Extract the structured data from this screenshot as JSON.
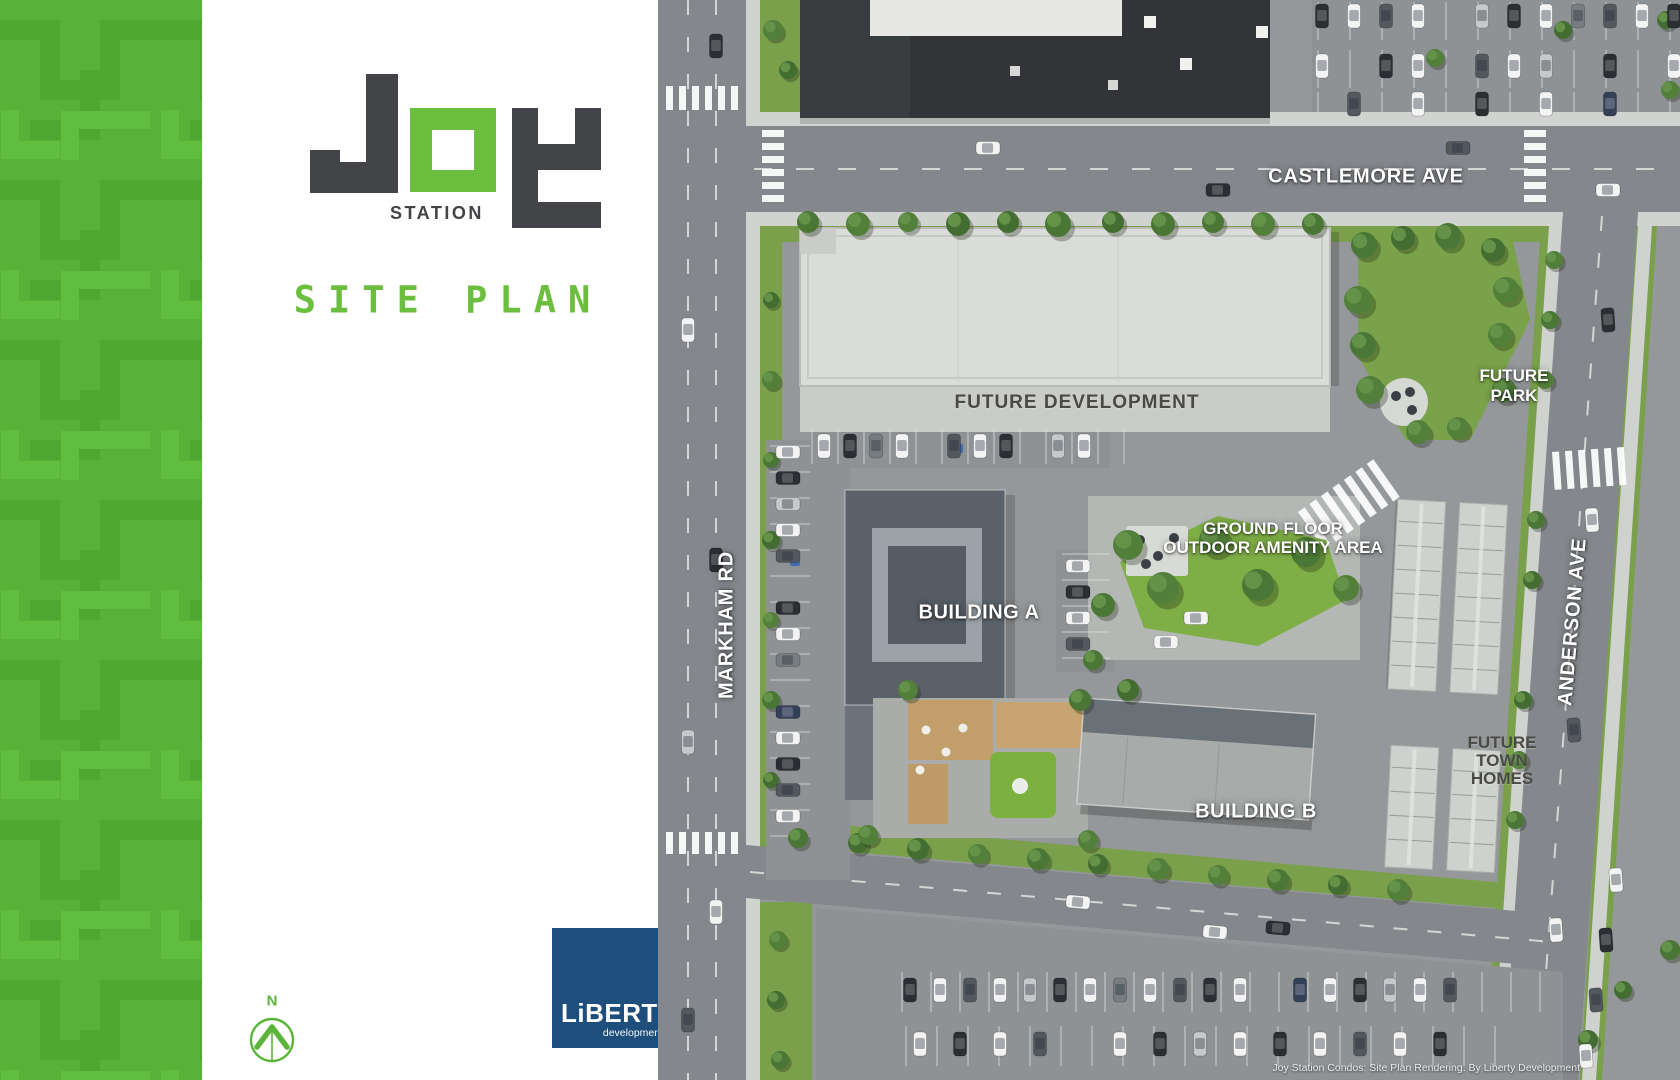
{
  "page": {
    "title": "Joy Station Site Plan"
  },
  "panel": {
    "logo": {
      "word": "JOY",
      "subtitle": "STATION"
    },
    "site_plan_label": "SITE PLAN",
    "compass": {
      "label": "N"
    },
    "liberty": {
      "name": "LiBERTY",
      "subtitle": "development"
    }
  },
  "map": {
    "street_labels": {
      "castlemore": "CASTLEMORE AVE",
      "markham": "MARKHAM RD",
      "anderson": "ANDERSON AVE"
    },
    "area_labels": {
      "future_development": "FUTURE DEVELOPMENT",
      "future_park": [
        "FUTURE",
        "PARK"
      ],
      "amenity": [
        "GROUND FLOOR",
        "OUTDOOR AMENITY AREA"
      ],
      "building_a": "BUILDING A",
      "building_b": "BUILDING B",
      "town_homes": [
        "FUTURE",
        "TOWN",
        "HOMES"
      ]
    },
    "caption": "Joy Station Condos: Site Plan Rendering. By Liberty Development"
  },
  "colors": {
    "accent_green": "#5cb53a",
    "logo_green": "#6cbe3e",
    "logo_dark": "#424448",
    "liberty_blue": "#1e4e7c",
    "label_white": "#ffffff",
    "label_dark": "#4a4a45"
  }
}
